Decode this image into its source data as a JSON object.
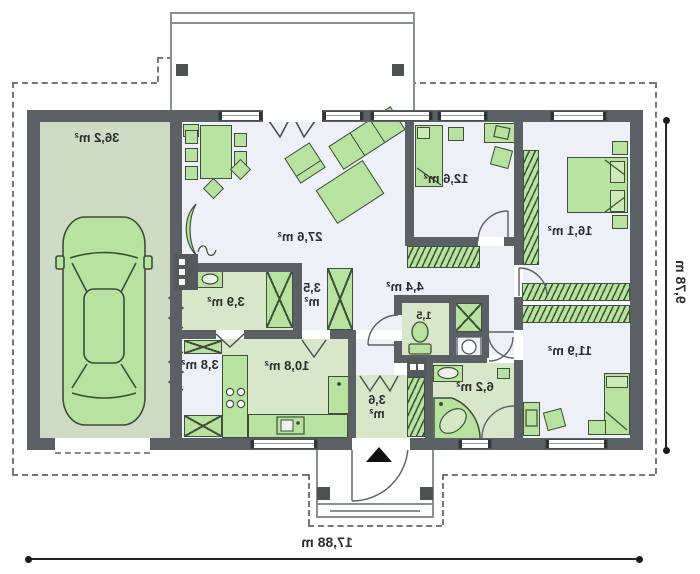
{
  "rooms": {
    "garage": {
      "label": "36,2 m²"
    },
    "living": {
      "label": "27,6 m²"
    },
    "bedroom1": {
      "label": "12,6 m²"
    },
    "bedroom2": {
      "label": "16,1 m²"
    },
    "bedroom3": {
      "label": "11,9 m²"
    },
    "bathroom": {
      "label": "6,2 m²"
    },
    "wc": {
      "label": "1,5"
    },
    "hall": {
      "label": "4,4 m²"
    },
    "wardrobe": {
      "value": "3,5",
      "unit": "m²"
    },
    "utility": {
      "label": "3,9 m²"
    },
    "hall2": {
      "label": "3,8 m²"
    },
    "kitchen": {
      "label": "10,8 m²"
    },
    "entry": {
      "value": "3,6",
      "unit": "m²"
    }
  },
  "dimensions": {
    "width": "17,88 m",
    "depth": "9,78 m"
  },
  "palette": {
    "wall": "#5a6063",
    "roomw": "#edf1f7",
    "green": "#d8e7ca",
    "garage": "#cfdcc5",
    "furn": "#b7e2a0",
    "furnb": "#3f4f3a"
  }
}
